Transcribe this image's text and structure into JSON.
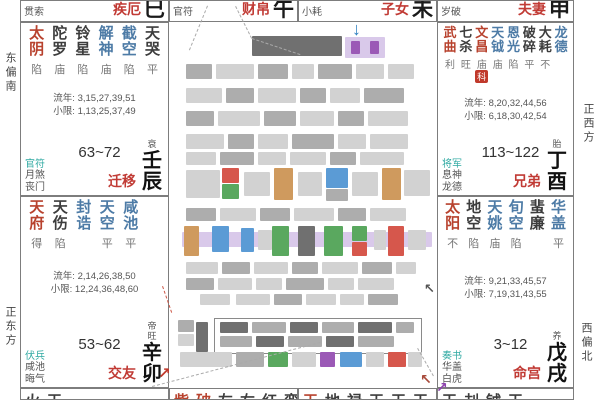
{
  "edge_labels": {
    "left_top": "东偏南",
    "left_bottom": "正东方",
    "right_top": "正西方",
    "right_bottom": "西偏北"
  },
  "colors": {
    "major_star": "#b8422e",
    "good_star": "#4d7ba6",
    "bad_star": "#3d3d3d",
    "palace_red": "#c13b35",
    "shensha_teal": "#2fa9a2",
    "badge_red": "#c0392b",
    "blue_arrow": "#2e7fc0",
    "purple_arrow": "#8e44ad"
  },
  "top_cells": [
    {
      "header": "贯索",
      "palace_name": "疾厄",
      "branch": "巳"
    },
    {
      "header": "官符",
      "palace_name": "财帛",
      "branch": "午"
    },
    {
      "header": "小耗",
      "palace_name": "子女",
      "branch": "未"
    },
    {
      "header": "岁破",
      "palace_name": "夫妻",
      "branch": "申"
    }
  ],
  "palaces": [
    {
      "id": "chen",
      "stars": [
        {
          "name": "太阴",
          "type": "major",
          "bright": "陷"
        },
        {
          "name": "陀罗",
          "type": "bad",
          "bright": "庙"
        },
        {
          "name": "铃星",
          "type": "bad",
          "bright": "陷"
        },
        {
          "name": "解神",
          "type": "good",
          "bright": "庙"
        },
        {
          "name": "截空",
          "type": "good",
          "bright": "陷"
        },
        {
          "name": "天哭",
          "type": "bad",
          "bright": "平"
        }
      ],
      "liunian": "流年: 3,15,27,39,51",
      "xiaoxian": "小限: 1,13,25,37,49",
      "shensha": [
        "官符",
        "月煞",
        "丧门"
      ],
      "age_range": "63~72",
      "changsheng": "衰",
      "palace_name": "迁移",
      "ganzhi": "壬辰"
    },
    {
      "id": "mao",
      "stars": [
        {
          "name": "天府",
          "type": "major",
          "bright": "得"
        },
        {
          "name": "天伤",
          "type": "bad",
          "bright": "陷"
        },
        {
          "name": "封诰",
          "type": "good",
          "bright": ""
        },
        {
          "name": "天空",
          "type": "good",
          "bright": "平"
        },
        {
          "name": "咸池",
          "type": "good",
          "bright": "平"
        }
      ],
      "liunian": "流年: 2,14,26,38,50",
      "xiaoxian": "小限: 12,24,36,48,60",
      "shensha": [
        "伏兵",
        "咸池",
        "晦气"
      ],
      "age_range": "53~62",
      "changsheng": "帝旺",
      "palace_name": "交友",
      "ganzhi": "辛卯"
    },
    {
      "id": "you",
      "stars": [
        {
          "name": "武曲",
          "type": "major",
          "bright": "利"
        },
        {
          "name": "七杀",
          "type": "bad",
          "bright": "旺"
        },
        {
          "name": "文昌",
          "type": "major",
          "bright": "庙",
          "badge": "科"
        },
        {
          "name": "天钺",
          "type": "good",
          "bright": "庙"
        },
        {
          "name": "恩光",
          "type": "good",
          "bright": "陷"
        },
        {
          "name": "破碎",
          "type": "bad",
          "bright": "平"
        },
        {
          "name": "大耗",
          "type": "bad",
          "bright": "不"
        },
        {
          "name": "龙德",
          "type": "good",
          "bright": ""
        }
      ],
      "liunian": "流年: 8,20,32,44,56",
      "xiaoxian": "小限: 6,18,30,42,54",
      "shensha": [
        "将军",
        "息神",
        "龙德"
      ],
      "age_range": "113~122",
      "changsheng": "胎",
      "palace_name": "兄弟",
      "ganzhi": "丁酉"
    },
    {
      "id": "xu",
      "stars": [
        {
          "name": "太阳",
          "type": "major",
          "bright": "不"
        },
        {
          "name": "地空",
          "type": "bad",
          "bright": "陷"
        },
        {
          "name": "天姚",
          "type": "good",
          "bright": "庙"
        },
        {
          "name": "旬空",
          "type": "good",
          "bright": "陷"
        },
        {
          "name": "蜚廉",
          "type": "bad",
          "bright": ""
        },
        {
          "name": "华盖",
          "type": "good",
          "bright": "平"
        }
      ],
      "liunian": "流年: 9,21,33,45,57",
      "xiaoxian": "小限: 7,19,31,43,55",
      "shensha": [
        "奏书",
        "华盖",
        "白虎"
      ],
      "age_range": "3~12",
      "changsheng": "养",
      "palace_name": "命宫",
      "ganzhi": "戊戌"
    }
  ],
  "bottom_cells": [
    {
      "lead": "",
      "rest": "火天"
    },
    {
      "lead": "紫破",
      "rest": "左右红鸾"
    },
    {
      "lead": "天",
      "rest": "地禄天天天"
    },
    {
      "lead": "",
      "rest": "天刦钺天"
    }
  ],
  "censored_blocks": [
    {
      "x": 252,
      "y": 36,
      "w": 90,
      "h": 20,
      "c": "d"
    },
    {
      "x": 345,
      "y": 37,
      "w": 40,
      "h": 21,
      "c": "lav"
    },
    {
      "x": 351,
      "y": 41,
      "w": 9,
      "h": 13,
      "c": "purple"
    },
    {
      "x": 370,
      "y": 41,
      "w": 9,
      "h": 13,
      "c": "purple"
    },
    {
      "x": 186,
      "y": 64,
      "w": 26,
      "h": 15,
      "c": "b"
    },
    {
      "x": 216,
      "y": 64,
      "w": 38,
      "h": 15,
      "c": "a"
    },
    {
      "x": 258,
      "y": 64,
      "w": 30,
      "h": 15,
      "c": "b"
    },
    {
      "x": 292,
      "y": 64,
      "w": 22,
      "h": 15,
      "c": "a"
    },
    {
      "x": 318,
      "y": 64,
      "w": 34,
      "h": 15,
      "c": "b"
    },
    {
      "x": 356,
      "y": 64,
      "w": 28,
      "h": 15,
      "c": "a"
    },
    {
      "x": 388,
      "y": 64,
      "w": 26,
      "h": 15,
      "c": "a"
    },
    {
      "x": 186,
      "y": 88,
      "w": 36,
      "h": 15,
      "c": "a"
    },
    {
      "x": 226,
      "y": 88,
      "w": 28,
      "h": 15,
      "c": "b"
    },
    {
      "x": 258,
      "y": 88,
      "w": 38,
      "h": 15,
      "c": "a"
    },
    {
      "x": 300,
      "y": 88,
      "w": 26,
      "h": 15,
      "c": "b"
    },
    {
      "x": 330,
      "y": 88,
      "w": 30,
      "h": 15,
      "c": "a"
    },
    {
      "x": 364,
      "y": 88,
      "w": 40,
      "h": 15,
      "c": "b"
    },
    {
      "x": 186,
      "y": 111,
      "w": 28,
      "h": 15,
      "c": "b"
    },
    {
      "x": 218,
      "y": 111,
      "w": 42,
      "h": 15,
      "c": "a"
    },
    {
      "x": 264,
      "y": 111,
      "w": 32,
      "h": 15,
      "c": "b"
    },
    {
      "x": 300,
      "y": 111,
      "w": 34,
      "h": 15,
      "c": "a"
    },
    {
      "x": 338,
      "y": 111,
      "w": 26,
      "h": 15,
      "c": "b"
    },
    {
      "x": 368,
      "y": 111,
      "w": 40,
      "h": 15,
      "c": "a"
    },
    {
      "x": 186,
      "y": 134,
      "w": 38,
      "h": 15,
      "c": "a"
    },
    {
      "x": 228,
      "y": 134,
      "w": 26,
      "h": 15,
      "c": "b"
    },
    {
      "x": 258,
      "y": 134,
      "w": 30,
      "h": 15,
      "c": "a"
    },
    {
      "x": 292,
      "y": 134,
      "w": 42,
      "h": 15,
      "c": "b"
    },
    {
      "x": 338,
      "y": 134,
      "w": 28,
      "h": 15,
      "c": "a"
    },
    {
      "x": 370,
      "y": 134,
      "w": 38,
      "h": 15,
      "c": "a"
    },
    {
      "x": 186,
      "y": 152,
      "w": 30,
      "h": 13,
      "c": "a"
    },
    {
      "x": 220,
      "y": 152,
      "w": 34,
      "h": 13,
      "c": "b"
    },
    {
      "x": 258,
      "y": 152,
      "w": 28,
      "h": 13,
      "c": "a"
    },
    {
      "x": 290,
      "y": 152,
      "w": 36,
      "h": 13,
      "c": "a"
    },
    {
      "x": 330,
      "y": 152,
      "w": 26,
      "h": 13,
      "c": "b"
    },
    {
      "x": 360,
      "y": 152,
      "w": 44,
      "h": 13,
      "c": "a"
    },
    {
      "x": 186,
      "y": 170,
      "w": 34,
      "h": 28,
      "c": "a"
    },
    {
      "x": 222,
      "y": 168,
      "w": 17,
      "h": 15,
      "c": "red"
    },
    {
      "x": 222,
      "y": 184,
      "w": 17,
      "h": 15,
      "c": "green"
    },
    {
      "x": 244,
      "y": 172,
      "w": 26,
      "h": 24,
      "c": "a"
    },
    {
      "x": 274,
      "y": 168,
      "w": 19,
      "h": 32,
      "c": "orange"
    },
    {
      "x": 298,
      "y": 172,
      "w": 24,
      "h": 24,
      "c": "a"
    },
    {
      "x": 326,
      "y": 168,
      "w": 22,
      "h": 20,
      "c": "blue"
    },
    {
      "x": 326,
      "y": 189,
      "w": 22,
      "h": 12,
      "c": "b"
    },
    {
      "x": 352,
      "y": 172,
      "w": 26,
      "h": 24,
      "c": "a"
    },
    {
      "x": 382,
      "y": 168,
      "w": 19,
      "h": 32,
      "c": "orange"
    },
    {
      "x": 404,
      "y": 170,
      "w": 26,
      "h": 26,
      "c": "a"
    },
    {
      "x": 186,
      "y": 208,
      "w": 30,
      "h": 13,
      "c": "b"
    },
    {
      "x": 220,
      "y": 208,
      "w": 36,
      "h": 13,
      "c": "a"
    },
    {
      "x": 260,
      "y": 208,
      "w": 30,
      "h": 13,
      "c": "b"
    },
    {
      "x": 294,
      "y": 208,
      "w": 40,
      "h": 13,
      "c": "a"
    },
    {
      "x": 338,
      "y": 208,
      "w": 28,
      "h": 13,
      "c": "b"
    },
    {
      "x": 370,
      "y": 208,
      "w": 36,
      "h": 13,
      "c": "a"
    },
    {
      "x": 182,
      "y": 232,
      "w": 250,
      "h": 15,
      "c": "lav"
    },
    {
      "x": 184,
      "y": 226,
      "w": 15,
      "h": 30,
      "c": "orange"
    },
    {
      "x": 212,
      "y": 226,
      "w": 17,
      "h": 26,
      "c": "blue"
    },
    {
      "x": 241,
      "y": 228,
      "w": 13,
      "h": 24,
      "c": "blue"
    },
    {
      "x": 258,
      "y": 230,
      "w": 14,
      "h": 20,
      "c": "a"
    },
    {
      "x": 272,
      "y": 226,
      "w": 17,
      "h": 30,
      "c": "green"
    },
    {
      "x": 298,
      "y": 226,
      "w": 17,
      "h": 30,
      "c": "d"
    },
    {
      "x": 324,
      "y": 226,
      "w": 19,
      "h": 30,
      "c": "green"
    },
    {
      "x": 352,
      "y": 226,
      "w": 15,
      "h": 15,
      "c": "green"
    },
    {
      "x": 352,
      "y": 242,
      "w": 15,
      "h": 14,
      "c": "red"
    },
    {
      "x": 374,
      "y": 230,
      "w": 12,
      "h": 20,
      "c": "a"
    },
    {
      "x": 388,
      "y": 226,
      "w": 16,
      "h": 30,
      "c": "red"
    },
    {
      "x": 408,
      "y": 230,
      "w": 18,
      "h": 20,
      "c": "a"
    },
    {
      "x": 186,
      "y": 262,
      "w": 32,
      "h": 12,
      "c": "a"
    },
    {
      "x": 222,
      "y": 262,
      "w": 28,
      "h": 12,
      "c": "b"
    },
    {
      "x": 254,
      "y": 262,
      "w": 34,
      "h": 12,
      "c": "a"
    },
    {
      "x": 292,
      "y": 262,
      "w": 26,
      "h": 12,
      "c": "b"
    },
    {
      "x": 322,
      "y": 262,
      "w": 36,
      "h": 12,
      "c": "a"
    },
    {
      "x": 362,
      "y": 262,
      "w": 30,
      "h": 12,
      "c": "b"
    },
    {
      "x": 396,
      "y": 262,
      "w": 20,
      "h": 12,
      "c": "a"
    },
    {
      "x": 186,
      "y": 278,
      "w": 28,
      "h": 12,
      "c": "b"
    },
    {
      "x": 218,
      "y": 278,
      "w": 34,
      "h": 12,
      "c": "a"
    },
    {
      "x": 256,
      "y": 278,
      "w": 26,
      "h": 12,
      "c": "a"
    },
    {
      "x": 286,
      "y": 278,
      "w": 38,
      "h": 12,
      "c": "b"
    },
    {
      "x": 328,
      "y": 278,
      "w": 26,
      "h": 12,
      "c": "a"
    },
    {
      "x": 358,
      "y": 278,
      "w": 36,
      "h": 12,
      "c": "a"
    },
    {
      "x": 200,
      "y": 294,
      "w": 30,
      "h": 11,
      "c": "a"
    },
    {
      "x": 236,
      "y": 294,
      "w": 34,
      "h": 11,
      "c": "a"
    },
    {
      "x": 274,
      "y": 294,
      "w": 28,
      "h": 11,
      "c": "b"
    },
    {
      "x": 306,
      "y": 294,
      "w": 30,
      "h": 11,
      "c": "a"
    },
    {
      "x": 340,
      "y": 294,
      "w": 24,
      "h": 11,
      "c": "a"
    },
    {
      "x": 368,
      "y": 294,
      "w": 30,
      "h": 11,
      "c": "b"
    },
    {
      "x": 220,
      "y": 322,
      "w": 28,
      "h": 11,
      "c": "d"
    },
    {
      "x": 252,
      "y": 322,
      "w": 34,
      "h": 11,
      "c": "b"
    },
    {
      "x": 290,
      "y": 322,
      "w": 28,
      "h": 11,
      "c": "d"
    },
    {
      "x": 322,
      "y": 322,
      "w": 32,
      "h": 11,
      "c": "b"
    },
    {
      "x": 358,
      "y": 322,
      "w": 34,
      "h": 11,
      "c": "d"
    },
    {
      "x": 396,
      "y": 322,
      "w": 18,
      "h": 11,
      "c": "b"
    },
    {
      "x": 220,
      "y": 336,
      "w": 32,
      "h": 11,
      "c": "b"
    },
    {
      "x": 256,
      "y": 336,
      "w": 28,
      "h": 11,
      "c": "d"
    },
    {
      "x": 288,
      "y": 336,
      "w": 34,
      "h": 11,
      "c": "b"
    },
    {
      "x": 326,
      "y": 336,
      "w": 28,
      "h": 11,
      "c": "d"
    },
    {
      "x": 358,
      "y": 336,
      "w": 36,
      "h": 11,
      "c": "b"
    },
    {
      "x": 178,
      "y": 320,
      "w": 16,
      "h": 12,
      "c": "b"
    },
    {
      "x": 178,
      "y": 334,
      "w": 16,
      "h": 12,
      "c": "a"
    },
    {
      "x": 196,
      "y": 322,
      "w": 12,
      "h": 30,
      "c": "d"
    },
    {
      "x": 180,
      "y": 352,
      "w": 52,
      "h": 15,
      "c": "a"
    },
    {
      "x": 236,
      "y": 352,
      "w": 28,
      "h": 15,
      "c": "b"
    },
    {
      "x": 268,
      "y": 352,
      "w": 20,
      "h": 15,
      "c": "green"
    },
    {
      "x": 292,
      "y": 352,
      "w": 24,
      "h": 15,
      "c": "a"
    },
    {
      "x": 320,
      "y": 352,
      "w": 15,
      "h": 15,
      "c": "purple"
    },
    {
      "x": 340,
      "y": 352,
      "w": 22,
      "h": 15,
      "c": "blue"
    },
    {
      "x": 366,
      "y": 352,
      "w": 18,
      "h": 15,
      "c": "a"
    },
    {
      "x": 388,
      "y": 352,
      "w": 18,
      "h": 15,
      "c": "red"
    },
    {
      "x": 408,
      "y": 352,
      "w": 14,
      "h": 15,
      "c": "a"
    }
  ],
  "center_box": {
    "x": 214,
    "y": 318,
    "w": 206,
    "h": 34
  },
  "dashed_lines": [
    {
      "x1": 236,
      "y1": 6,
      "x2": 252,
      "y2": 38,
      "c": "#aaaaaa"
    },
    {
      "x1": 252,
      "y1": 38,
      "x2": 300,
      "y2": 54,
      "c": "#aaaaaa"
    },
    {
      "x1": 208,
      "y1": 6,
      "x2": 190,
      "y2": 50,
      "c": "#aaaaaa"
    },
    {
      "x1": 152,
      "y1": 386,
      "x2": 320,
      "y2": 342,
      "c": "#aaaaaa"
    },
    {
      "x1": 418,
      "y1": 348,
      "x2": 434,
      "y2": 376,
      "c": "#aaaaaa"
    },
    {
      "x1": 163,
      "y1": 286,
      "x2": 172,
      "y2": 312,
      "c": "#cc5544"
    }
  ],
  "arrows": [
    {
      "glyph": "↓",
      "x": 352,
      "y": 20,
      "size": 18,
      "color": "#2e7fc0",
      "name": "blue-down-arrow"
    },
    {
      "glyph": "↗",
      "x": 158,
      "y": 366,
      "size": 15,
      "color": "#c0392b",
      "name": "red-ne-arrow"
    },
    {
      "glyph": "↖",
      "x": 420,
      "y": 372,
      "size": 14,
      "color": "#a84a3a",
      "name": "red-nw-arrow"
    },
    {
      "glyph": "↗",
      "x": 436,
      "y": 380,
      "size": 14,
      "color": "#8e44ad",
      "name": "purple-ne-arrow"
    },
    {
      "glyph": "↖",
      "x": 424,
      "y": 282,
      "size": 13,
      "color": "#555555",
      "name": "gray-nw-arrow"
    }
  ]
}
